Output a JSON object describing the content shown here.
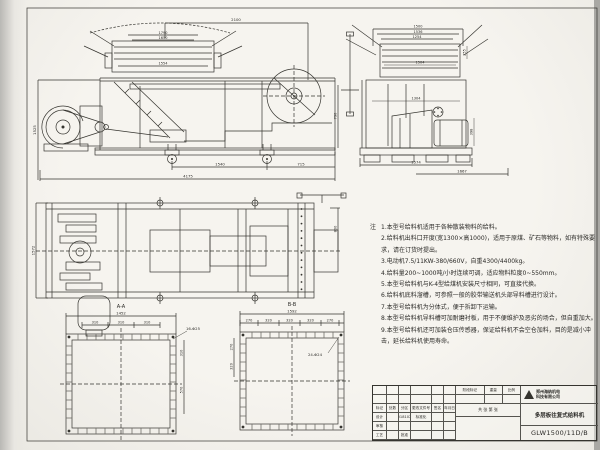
{
  "sheet": {
    "bg": "#f3f1ec",
    "line_color": "#35342f"
  },
  "views": {
    "side": {
      "dims": {
        "top_width": "2100",
        "hopper_a": "1790",
        "hopper_b": "1650",
        "hopper_inner": "1554",
        "left_height": "1525",
        "right_height": "790",
        "wheel_spacing": "1540",
        "rear_offset": "715",
        "overall_length": "4175"
      }
    },
    "end": {
      "dims": {
        "top_a": "1500",
        "top_b": "1536",
        "top_c": "1254",
        "deck_inner": "1504",
        "lip_height": "255",
        "body_inner": "1304",
        "motor_height": "398",
        "base_width": "1574",
        "offset_right": "1667"
      }
    },
    "plan": {
      "dims": {
        "width": "1572",
        "inlet_offset": "800"
      }
    },
    "section_aa": {
      "label": "A-A",
      "overall": "1452",
      "spacing": [
        "310",
        "310",
        "310"
      ],
      "holes": "16-Φ25",
      "side_a": "310",
      "side_b": "570"
    },
    "section_bb": {
      "label": "B-B",
      "overall": "1592",
      "spacing": [
        "270",
        "320",
        "320",
        "320",
        "270"
      ],
      "holes": "24-Φ24",
      "side_a": "270",
      "side_b": "320"
    }
  },
  "notes": {
    "heading": "注",
    "items": [
      "1.本型号给料机适用于各种散装物料的给料。",
      "2.给料机出料口开度(宽1300×高1000)，适用于原煤、矿石等物料，如有特殊要求，请在订货时提出。",
      "3.电动机7.5/11KW-380/660V，自重4300/4400kg。",
      "4.给料量200~1000吨/小时连续可调，适应物料粒度0~550mm。",
      "5.本型号给料机与K-4型给煤机安装尺寸相同，可直接代换。",
      "6.给料机底料溜槽，可参照一般的胶带输送机头部导料槽进行设计。",
      "7.本型号给料机为分体式，便于拆卸下运输。",
      "8.本型号给料机导料槽可加耐磨衬板，用于不便维护及恶劣的场合，但自重加大。",
      "9.本型号给料机还可加装仓压传感器，保证给料机不会空仓加料，目的是减小冲击，延长给料机使用寿命。"
    ]
  },
  "titleblock": {
    "company_line1": "郑州海纳机电",
    "company_line2": "科技有限公司",
    "product_name": "多层板往复式给料机",
    "drawing_no": "GLW1500/11D/B",
    "stage_header": [
      "阶段标记",
      "重量",
      "比例"
    ],
    "sheet_note": "共 张 第 张",
    "left_grid": [
      [
        "",
        "",
        "",
        "",
        "",
        ""
      ],
      [
        "",
        "",
        "",
        "",
        "",
        ""
      ],
      [
        "标记",
        "处数",
        "分区",
        "更改文件号",
        "签名",
        "年月日"
      ],
      [
        "设计",
        "",
        "20181026",
        "标准化",
        "",
        ""
      ],
      [
        "审核",
        "",
        "",
        "",
        "",
        ""
      ],
      [
        "工艺",
        "",
        "批准",
        "",
        "",
        ""
      ]
    ]
  }
}
